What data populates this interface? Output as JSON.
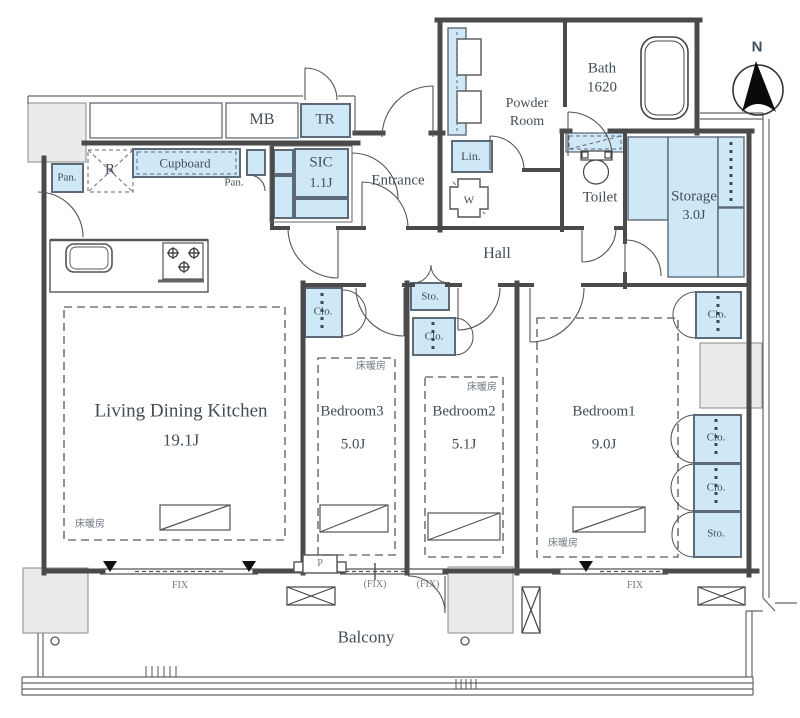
{
  "plan": {
    "rooms": {
      "ldk": {
        "label": "Living Dining Kitchen",
        "size": "19.1J"
      },
      "bedroom1": {
        "label": "Bedroom1",
        "size": "9.0J"
      },
      "bedroom2": {
        "label": "Bedroom2",
        "size": "5.1J"
      },
      "bedroom3": {
        "label": "Bedroom3",
        "size": "5.0J"
      },
      "bath": {
        "label": "Bath",
        "size": "1620"
      },
      "powder": {
        "line1": "Powder",
        "line2": "Room"
      },
      "toilet": {
        "label": "Toilet"
      },
      "storage": {
        "label": "Storage",
        "size": "3.0J"
      },
      "sic": {
        "label": "SIC",
        "size": "1.1J"
      },
      "entrance": {
        "label": "Entrance"
      },
      "hall": {
        "label": "Hall"
      },
      "balcony": {
        "label": "Balcony"
      }
    },
    "fixtures": {
      "mb": "MB",
      "tr": "TR",
      "cupboard": "Cupboard",
      "fridge": "R",
      "pan": "Pan.",
      "lin": "Lin.",
      "washer": "W",
      "clo": "Clo.",
      "sto": "Sto.",
      "pillar": "P"
    },
    "windows": {
      "fix": "FIX",
      "fix_paren": "(FIX)"
    },
    "annotations": {
      "floor_heating": "床暖房",
      "compass_north": "N"
    },
    "colors": {
      "accent_blue": "#cfe8f7",
      "pillar_gray": "#ebebeb",
      "wall": "#4a4a4a"
    }
  }
}
